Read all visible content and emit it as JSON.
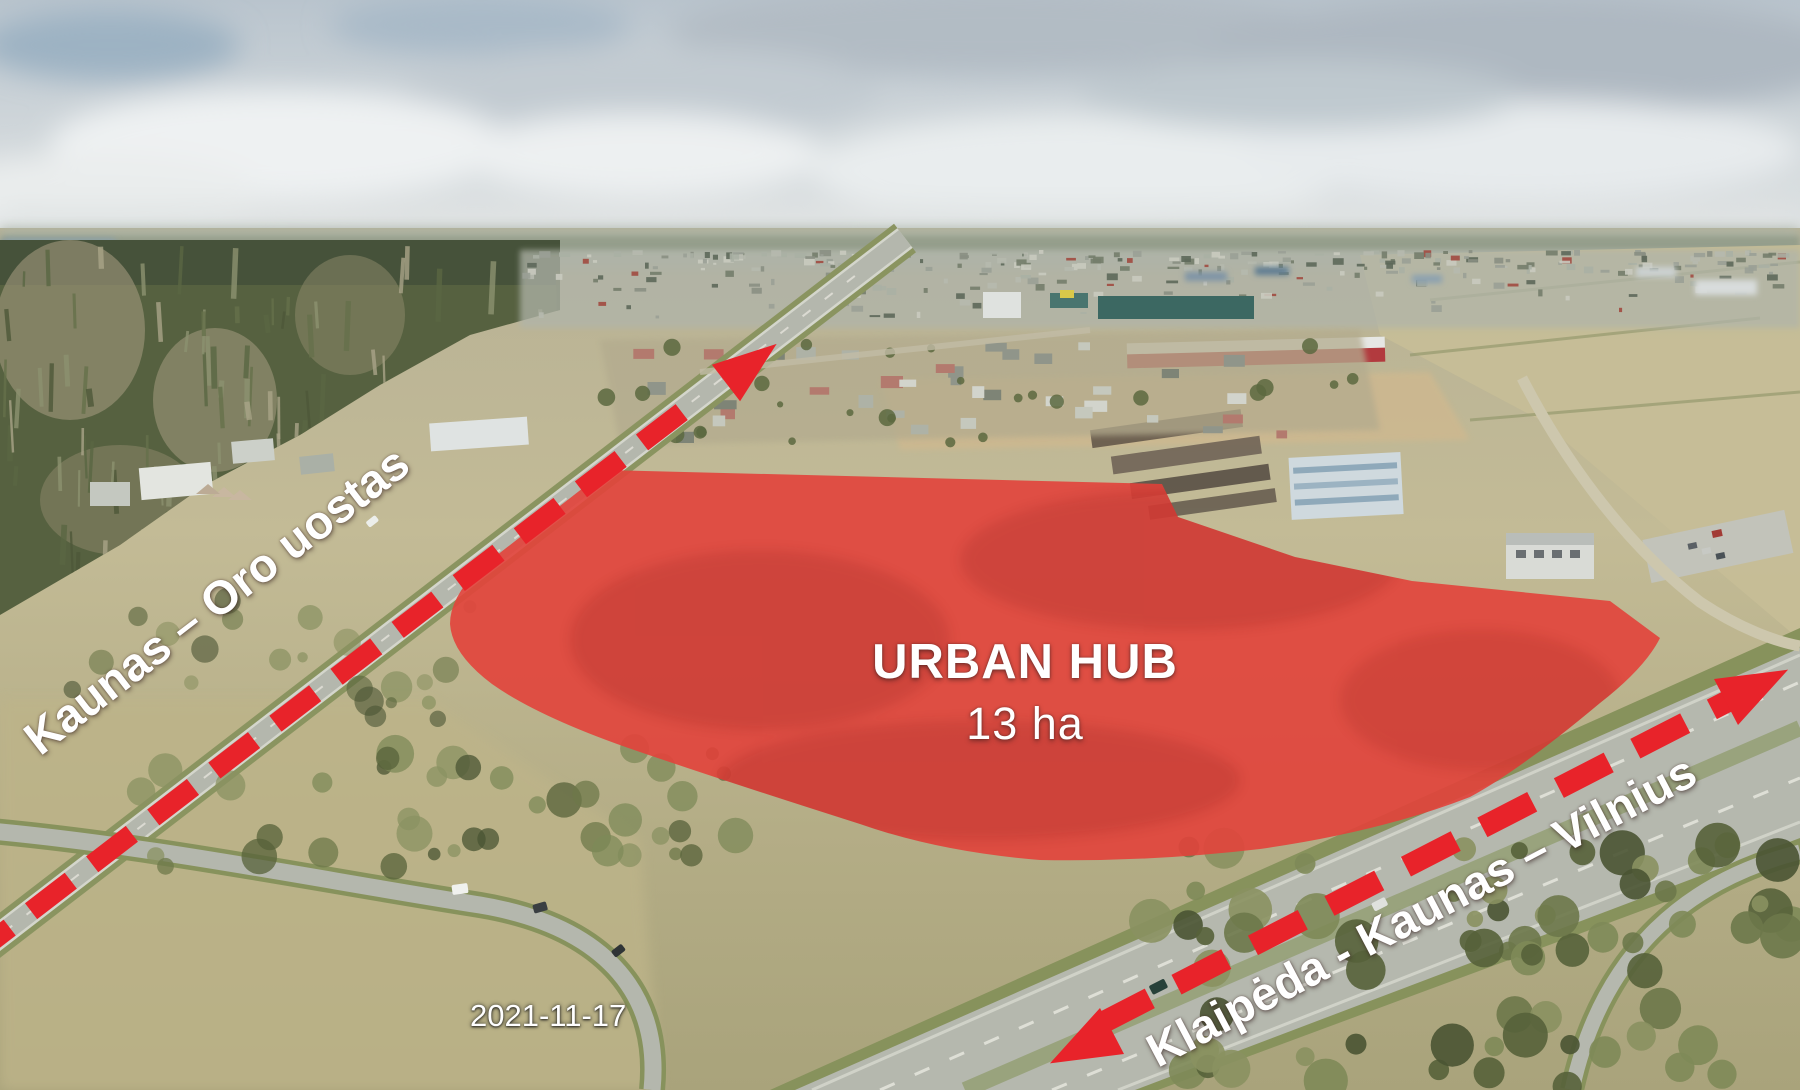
{
  "meta": {
    "width": 1800,
    "height": 1090,
    "kind": "annotated aerial photograph of development site"
  },
  "annotations": {
    "site_title": "URBAN HUB",
    "site_area": "13 ha",
    "road_label_airport": "Kaunas – Oro uostas",
    "road_label_highway": "Klaipėda - Kaunas – Vilnius",
    "date": "2021-11-17"
  },
  "arrows": [
    {
      "id": "airport-arrow",
      "label": "Kaunas – Oro uostas",
      "style": "dashed",
      "heads": "one (points to upper right)"
    },
    {
      "id": "highway-arrow",
      "label": "Klaipėda - Kaunas – Vilnius",
      "style": "dashed",
      "heads": "two (double-headed along highway)"
    }
  ],
  "colors": {
    "site_overlay": "#e2423b",
    "site_overlay_dark": "#b3201c",
    "arrow_red": "#e8232a",
    "label_white": "#ffffff"
  }
}
